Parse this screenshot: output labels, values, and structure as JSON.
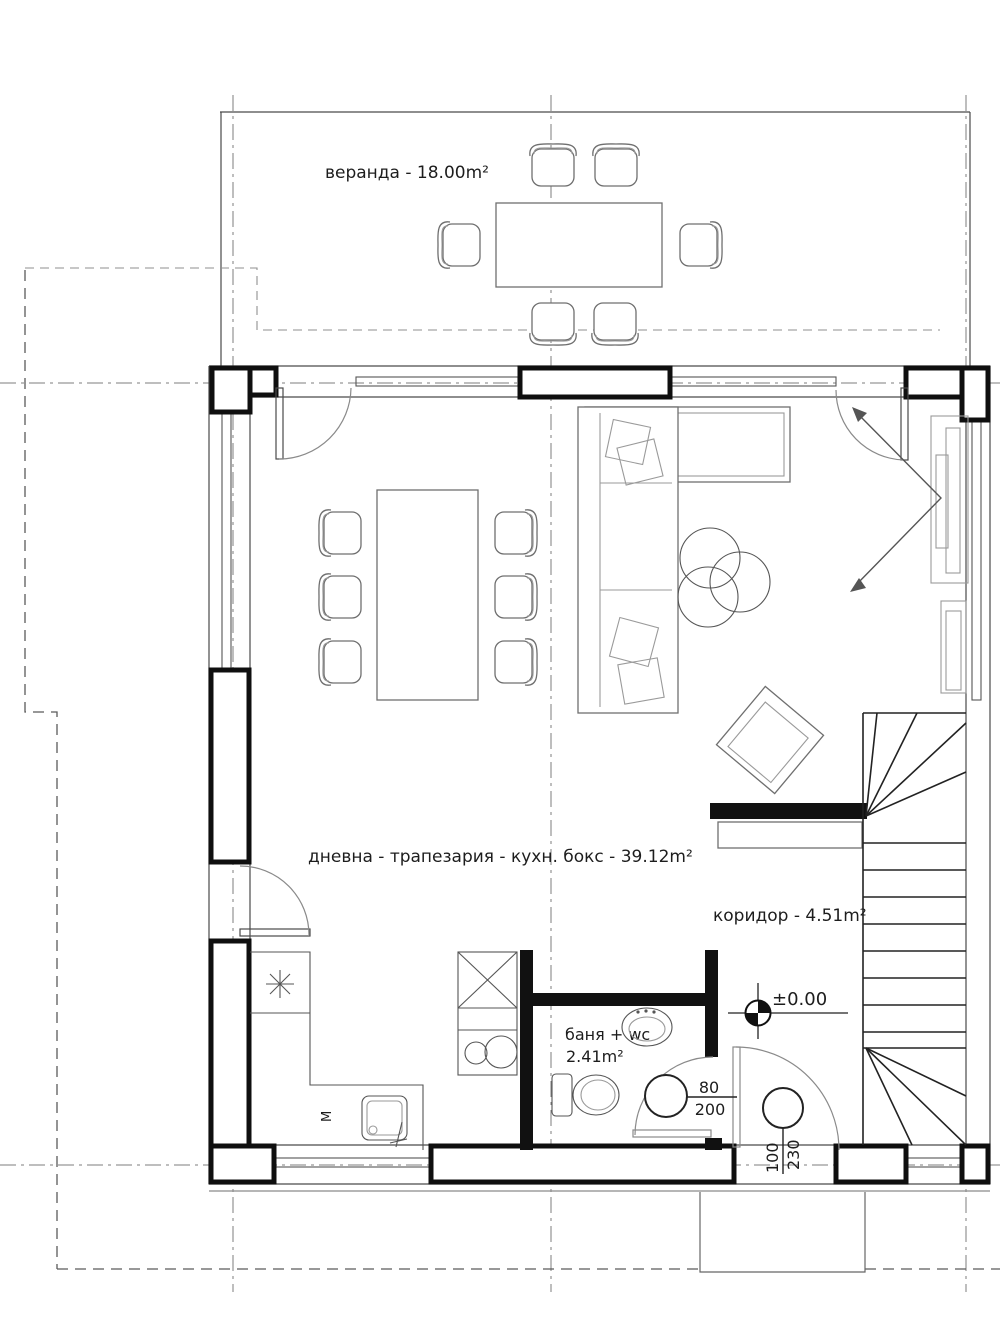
{
  "rooms": {
    "veranda": {
      "label": "веранда - 18.00m²"
    },
    "living": {
      "label": "дневна - трапезария - кухн. бокс - 39.12m²"
    },
    "corridor": {
      "label": "коридор - 4.51m²"
    },
    "bath": {
      "label": "баня + wc",
      "area": "2.41m²"
    }
  },
  "doors": {
    "bath_door": {
      "width": "80",
      "height": "200"
    },
    "entry_door": {
      "width": "100",
      "height": "230"
    }
  },
  "level_mark": {
    "value": "±0.00"
  },
  "kitchen": {
    "washer_label": "M"
  },
  "colors": {
    "line": "#1d1d1d",
    "wall": "#111111",
    "axis": "#7d7d7d"
  }
}
